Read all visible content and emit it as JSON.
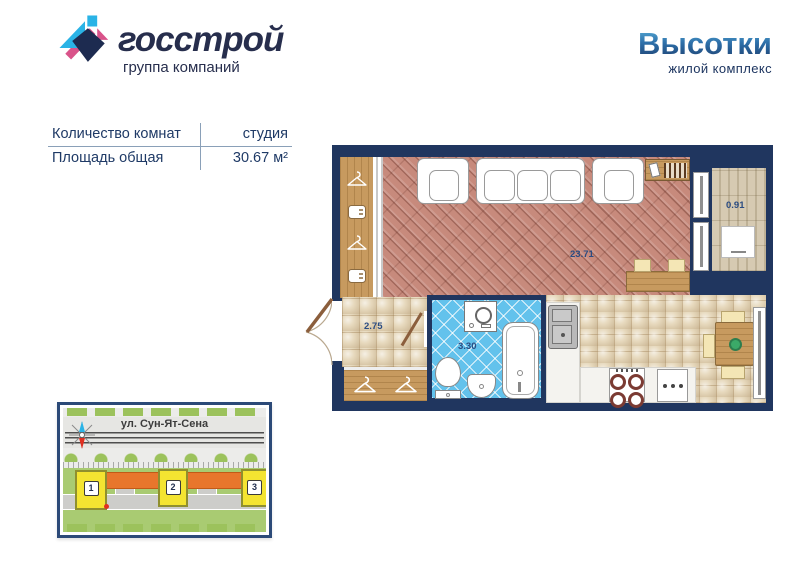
{
  "brand": {
    "name": "госстрой",
    "tagline": "группа компаний"
  },
  "complex": {
    "name": "Высотки",
    "tagline": "жилой комплекс"
  },
  "info_table": {
    "rows": [
      {
        "label": "Количество комнат",
        "value": "студия"
      },
      {
        "label": "Площадь общая",
        "value": "30.67 м²"
      }
    ]
  },
  "floorplan": {
    "areas": {
      "living": "23.71",
      "hallway": "2.75",
      "bathroom": "3.30",
      "balcony": "0.91"
    }
  },
  "site_map": {
    "street": "ул. Сун-Ят-Сена",
    "buildings": [
      "1",
      "2",
      "3"
    ]
  },
  "colors": {
    "navy": "#20365f",
    "logo_cyan": "#2ab3e6",
    "logo_pink": "#d9538a",
    "brick_floor": "#c78a7c",
    "bath_tile": "#63c2ec",
    "map_green": "#9cc25c",
    "map_orange": "#e8762c",
    "building_yellow": "#f4e431"
  }
}
